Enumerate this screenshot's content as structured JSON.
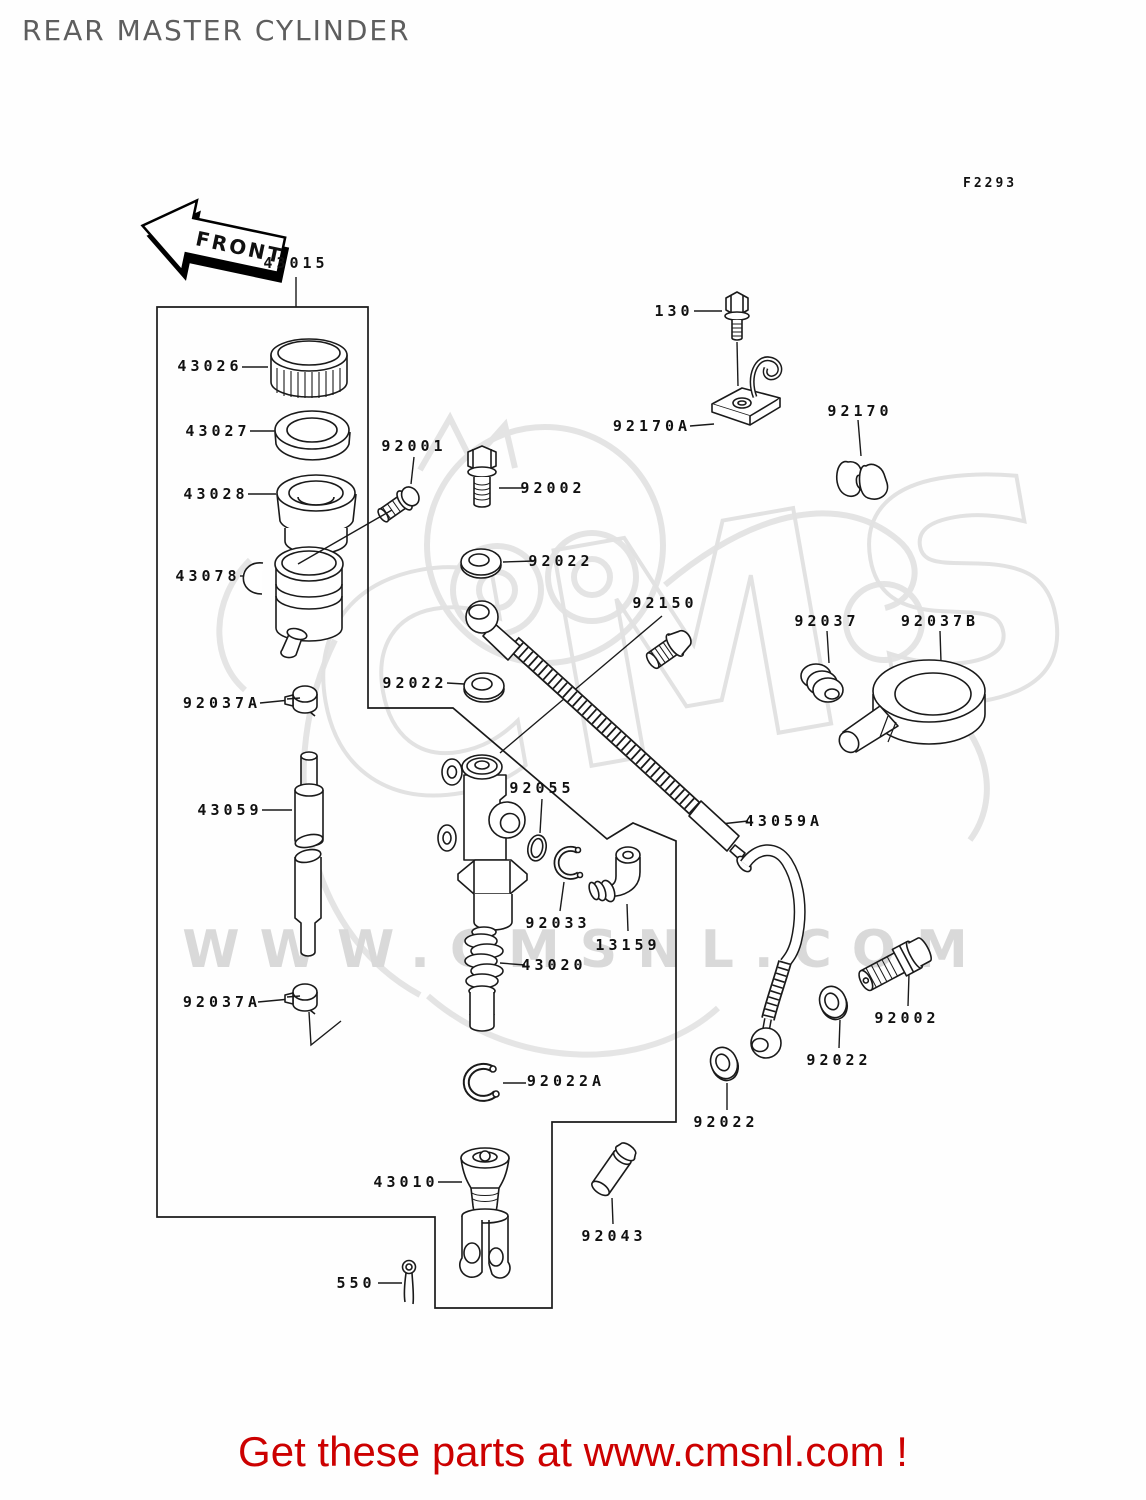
{
  "header": {
    "title": "REAR MASTER CYLINDER"
  },
  "diagram": {
    "fiche_code": "F2293",
    "front_arrow_label": "FRONT"
  },
  "watermark": {
    "big_text": "CMS",
    "site_text": "WWW.CMSNL.COM"
  },
  "footer": {
    "text": "Get these parts at www.cmsnl.com !"
  },
  "labels": [
    {
      "text": "43015"
    },
    {
      "text": "43026"
    },
    {
      "text": "43027"
    },
    {
      "text": "43028"
    },
    {
      "text": "92001"
    },
    {
      "text": "43078"
    },
    {
      "text": "92037A"
    },
    {
      "text": "43059"
    },
    {
      "text": "92037A"
    },
    {
      "text": "92022"
    },
    {
      "text": "92022"
    },
    {
      "text": "92002"
    },
    {
      "text": "92150"
    },
    {
      "text": "130"
    },
    {
      "text": "92170A"
    },
    {
      "text": "92170"
    },
    {
      "text": "92037"
    },
    {
      "text": "92037B"
    },
    {
      "text": "92055"
    },
    {
      "text": "92033"
    },
    {
      "text": "13159"
    },
    {
      "text": "43020"
    },
    {
      "text": "43059A"
    },
    {
      "text": "92022A"
    },
    {
      "text": "92002"
    },
    {
      "text": "92022"
    },
    {
      "text": "92022"
    },
    {
      "text": "43010"
    },
    {
      "text": "92043"
    },
    {
      "text": "550"
    }
  ]
}
